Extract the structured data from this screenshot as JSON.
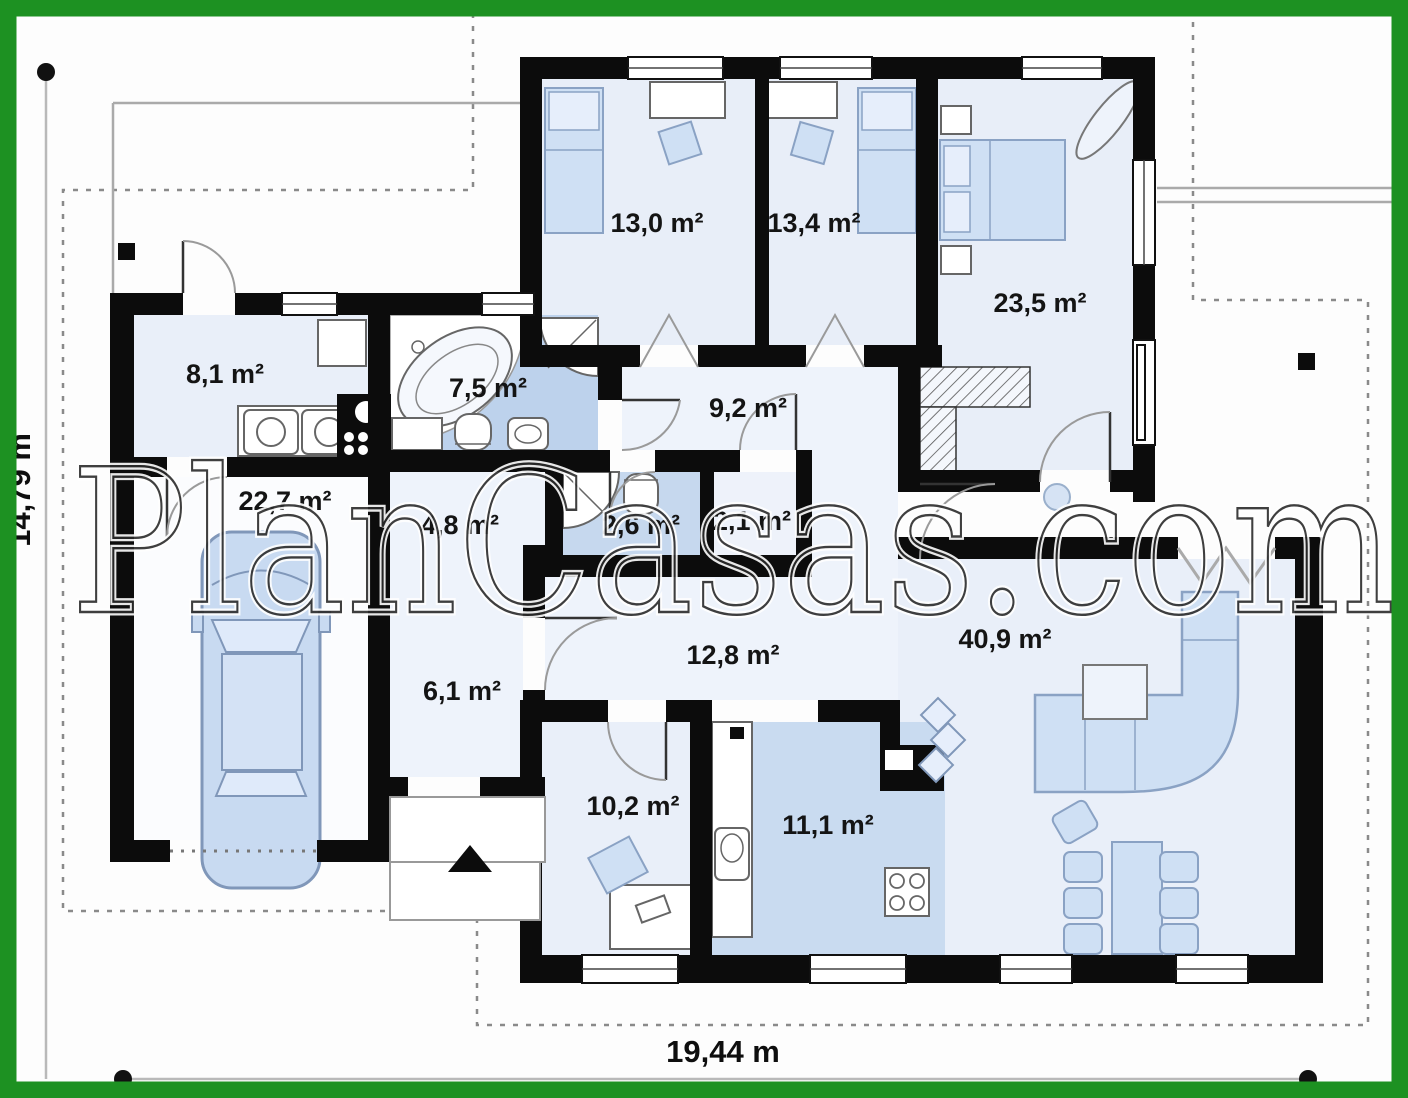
{
  "watermark": {
    "text": "PlanCasas.com"
  },
  "dimensions": {
    "width_label": "19,44 m",
    "height_label": "14,79 m"
  },
  "rooms": {
    "bedroom1": {
      "label": "13,0 m²"
    },
    "bedroom2": {
      "label": "13,4 m²"
    },
    "master_bedroom": {
      "label": "23,5 m²"
    },
    "utility": {
      "label": "8,1 m²"
    },
    "bathroom": {
      "label": "7,5 m²"
    },
    "hall_upper": {
      "label": "9,2 m²"
    },
    "garage": {
      "label": "22,7 m²"
    },
    "hall_mid": {
      "label": "4,8 m²"
    },
    "wc": {
      "label": "2,6 m²"
    },
    "closet": {
      "label": "2,1 m²"
    },
    "hall_entry": {
      "label": "6,1 m²"
    },
    "corridor": {
      "label": "12,8 m²"
    },
    "living_room": {
      "label": "40,9 m²"
    },
    "office": {
      "label": "10,2 m²"
    },
    "kitchen": {
      "label": "11,1 m²"
    }
  },
  "colors": {
    "frame": "#1d9122",
    "walls": "#0c0c0c",
    "room_floor": "#e8eef8",
    "corridor_floor": "#eef3fb",
    "wet_floor": "#bdd2ec",
    "furniture_blue": "#cfe0f4",
    "watermark_outline": "#2b2b2b"
  }
}
